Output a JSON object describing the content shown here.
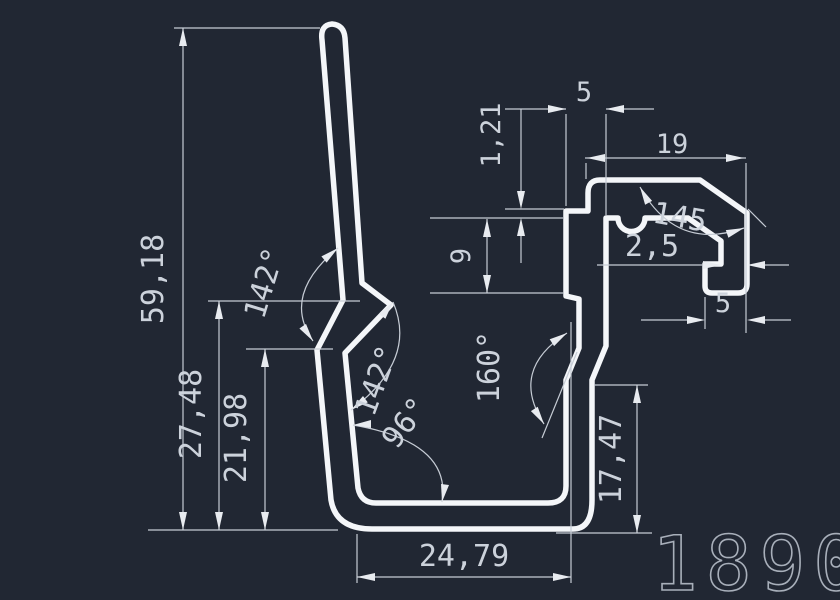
{
  "drawing": {
    "type": "extrusion-profile-cross-section",
    "part_number": "1890",
    "colors": {
      "background": "#212733",
      "profile_line": "#f4f6f9",
      "dimension_line": "#c6ccd5",
      "dimension_text": "#ccd2db",
      "part_number_text": "#a8afba"
    },
    "dims": {
      "total_height": "59,18",
      "mid_height": "27,48",
      "lower_height": "21,98",
      "bottom_width": "24,79",
      "right_height": "17,47",
      "step_height": "1,21",
      "pocket_height": "9",
      "top_width": "5",
      "arm_length": "19",
      "chamfer_angle": "145",
      "wall_thickness": "2,5",
      "foot_width": "5",
      "blade_angle_upper": "142°",
      "blade_angle_lower": "142°",
      "base_angle": "96°",
      "right_wall_angle": "160°"
    }
  }
}
